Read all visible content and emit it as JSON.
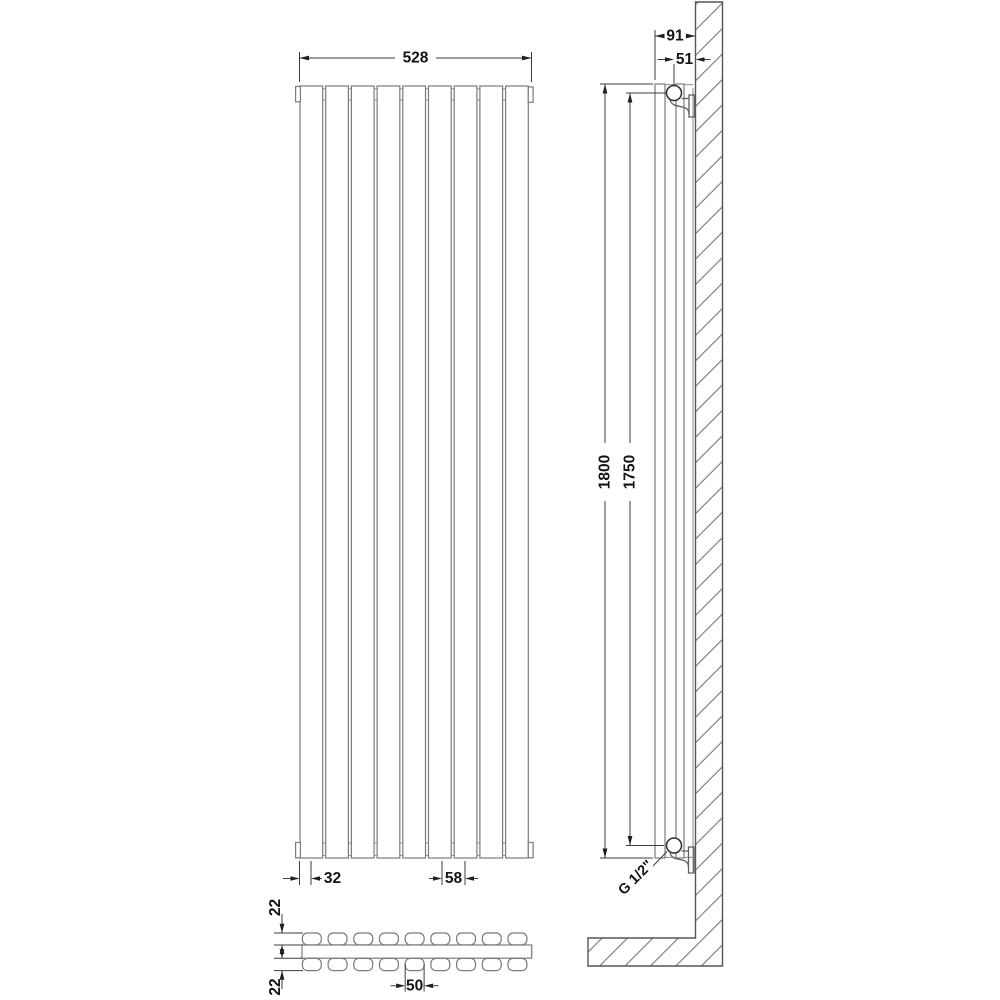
{
  "views": {
    "front": {
      "panel_count": 9,
      "dims": {
        "overall_width": "528",
        "edge_offset": "32",
        "panel_width": "58"
      }
    },
    "side": {
      "dims": {
        "overall_depth": "91",
        "pipe_centre_to_wall": "51",
        "overall_height": "1800",
        "pipe_centres": "1750"
      },
      "connection": "G 1/2\""
    },
    "plan": {
      "panel_count": 9,
      "dims": {
        "panel_depth_front": "22",
        "panel_depth_rear": "22",
        "panel_width": "50"
      }
    }
  }
}
